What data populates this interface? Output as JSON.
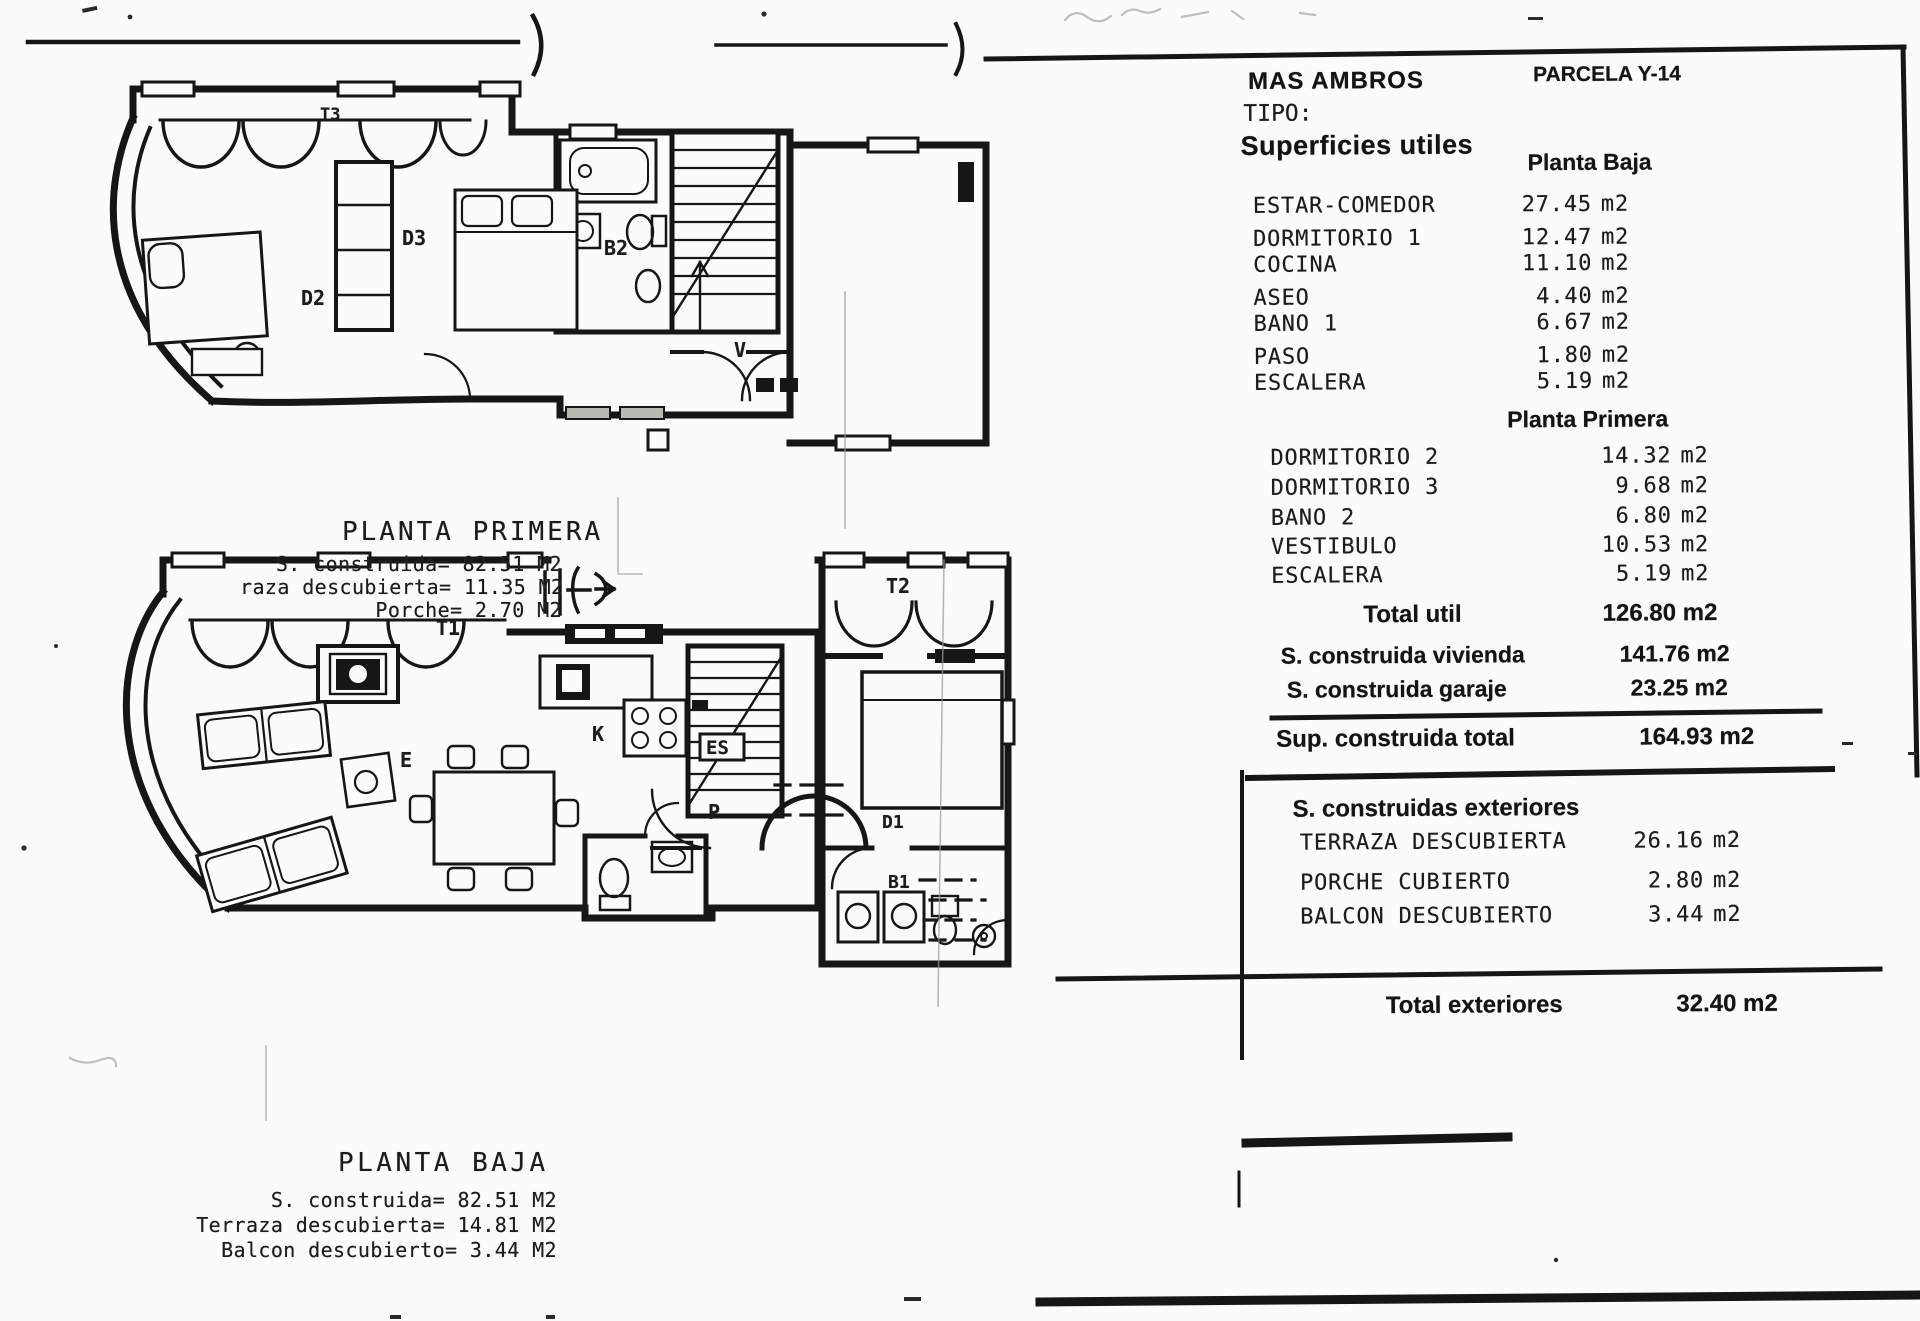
{
  "doc": {
    "project": "MAS AMBROS",
    "parcela": "PARCELA Y-14",
    "tipo_label": "TIPO:",
    "superficies_title": "Superficies utiles"
  },
  "tables": {
    "planta_baja": {
      "title": "Planta Baja",
      "rows": [
        {
          "label": "ESTAR-COMEDOR",
          "value": "27.45",
          "unit": "m2"
        },
        {
          "label": "DORMITORIO 1",
          "value": "12.47",
          "unit": "m2"
        },
        {
          "label": "COCINA",
          "value": "11.10",
          "unit": "m2"
        },
        {
          "label": "ASEO",
          "value": "4.40",
          "unit": "m2"
        },
        {
          "label": "BANO 1",
          "value": "6.67",
          "unit": "m2"
        },
        {
          "label": "PASO",
          "value": "1.80",
          "unit": "m2"
        },
        {
          "label": "ESCALERA",
          "value": "5.19",
          "unit": "m2"
        }
      ]
    },
    "planta_primera": {
      "title": "Planta Primera",
      "rows": [
        {
          "label": "DORMITORIO 2",
          "value": "14.32",
          "unit": "m2"
        },
        {
          "label": "DORMITORIO 3",
          "value": "9.68",
          "unit": "m2"
        },
        {
          "label": "BANO 2",
          "value": "6.80",
          "unit": "m2"
        },
        {
          "label": "VESTIBULO",
          "value": "10.53",
          "unit": "m2"
        },
        {
          "label": "ESCALERA",
          "value": "5.19",
          "unit": "m2"
        }
      ]
    },
    "total_util": {
      "label": "Total util",
      "value": "126.80 m2"
    },
    "construida_rows": [
      {
        "label": "S. construida vivienda",
        "value": "141.76 m2"
      },
      {
        "label": "S. construida garaje",
        "value": "23.25 m2"
      }
    ],
    "sup_total": {
      "label": "Sup. construida total",
      "value": "164.93 m2"
    },
    "exteriores": {
      "title": "S. construidas exteriores",
      "rows": [
        {
          "label": "TERRAZA DESCUBIERTA",
          "value": "26.16",
          "unit": "m2"
        },
        {
          "label": "PORCHE CUBIERTO",
          "value": "2.80",
          "unit": "m2"
        },
        {
          "label": "BALCON DESCUBIERTO",
          "value": "3.44",
          "unit": "m2"
        }
      ]
    },
    "total_exteriores": {
      "label": "Total exteriores",
      "value": "32.40 m2"
    }
  },
  "plans": {
    "primera": {
      "title": "PLANTA PRIMERA",
      "stats": [
        "S. construida= 82.51 M2",
        "raza descubierta= 11.35 M2",
        "Porche= 2.70 M2"
      ],
      "room_labels": {
        "t3": "T3",
        "d3": "D3",
        "d2": "D2",
        "b2": "B2",
        "v": "V"
      }
    },
    "baja": {
      "title": "PLANTA BAJA",
      "stats": [
        "S. construida= 82.51 M2",
        "Terraza descubierta= 14.81 M2",
        "Balcon descubierto= 3.44 M2"
      ],
      "room_labels": {
        "t1": "T1",
        "t2": "T2",
        "k": "K",
        "es": "ES",
        "p": "P",
        "e": "E",
        "d1": "D1",
        "b1": "B1"
      }
    }
  }
}
